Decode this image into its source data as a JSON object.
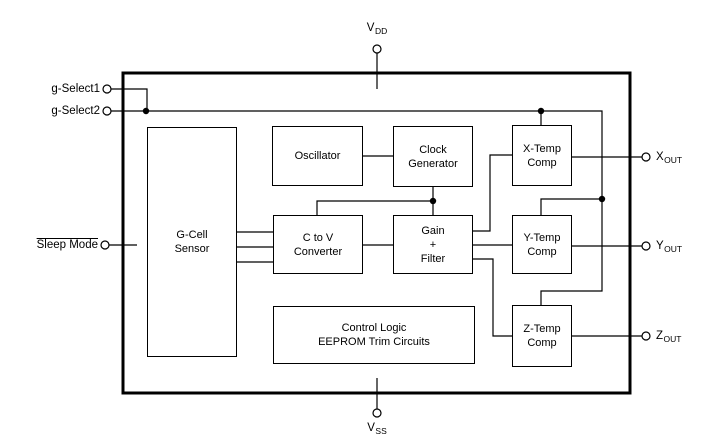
{
  "diagram": {
    "type": "block-diagram",
    "colors": {
      "line": "#000000",
      "background": "#ffffff",
      "text": "#000000"
    },
    "outer_box": {
      "x": 123,
      "y": 73,
      "w": 507,
      "h": 320
    },
    "blocks": [
      {
        "id": "g-cell-sensor",
        "label": [
          "G-Cell",
          "Sensor"
        ],
        "x": 147,
        "y": 127,
        "w": 90,
        "h": 230
      },
      {
        "id": "oscillator",
        "label": [
          "Oscillator"
        ],
        "x": 272,
        "y": 126,
        "w": 91,
        "h": 60
      },
      {
        "id": "clock-generator",
        "label": [
          "Clock",
          "Generator"
        ],
        "x": 393,
        "y": 126,
        "w": 80,
        "h": 61
      },
      {
        "id": "c-to-v-converter",
        "label": [
          "C to V",
          "Converter"
        ],
        "x": 273,
        "y": 215,
        "w": 90,
        "h": 59
      },
      {
        "id": "gain-filter",
        "label": [
          "Gain",
          "+",
          "Filter"
        ],
        "x": 393,
        "y": 215,
        "w": 80,
        "h": 59
      },
      {
        "id": "control-logic",
        "label": [
          "Control Logic",
          "EEPROM Trim Circuits"
        ],
        "x": 273,
        "y": 306,
        "w": 202,
        "h": 58
      },
      {
        "id": "x-temp-comp",
        "label": [
          "X-Temp",
          "Comp"
        ],
        "x": 512,
        "y": 125,
        "w": 60,
        "h": 61
      },
      {
        "id": "y-temp-comp",
        "label": [
          "Y-Temp",
          "Comp"
        ],
        "x": 512,
        "y": 215,
        "w": 60,
        "h": 59
      },
      {
        "id": "z-temp-comp",
        "label": [
          "Z-Temp",
          "Comp"
        ],
        "x": 512,
        "y": 305,
        "w": 60,
        "h": 62
      }
    ],
    "pins": [
      {
        "id": "vdd",
        "label": "V",
        "sub": "DD",
        "cx": 377,
        "cy": 49,
        "label_pos": "above",
        "overline": false
      },
      {
        "id": "vss",
        "label": "V",
        "sub": "SS",
        "cx": 377,
        "cy": 413,
        "label_pos": "below",
        "overline": false
      },
      {
        "id": "g-select1",
        "label": "g-Select1",
        "sub": "",
        "cx": 107,
        "cy": 89,
        "label_pos": "left",
        "overline": false
      },
      {
        "id": "g-select2",
        "label": "g-Select2",
        "sub": "",
        "cx": 107,
        "cy": 111,
        "label_pos": "left",
        "overline": false
      },
      {
        "id": "sleep-mode",
        "label": "Sleep Mode",
        "sub": "",
        "cx": 105,
        "cy": 245,
        "label_pos": "left",
        "overline": true
      },
      {
        "id": "xout",
        "label": "X",
        "sub": "OUT",
        "cx": 646,
        "cy": 157,
        "label_pos": "right",
        "overline": false
      },
      {
        "id": "yout",
        "label": "Y",
        "sub": "OUT",
        "cx": 646,
        "cy": 246,
        "label_pos": "right",
        "overline": false
      },
      {
        "id": "zout",
        "label": "Z",
        "sub": "OUT",
        "cx": 646,
        "cy": 336,
        "label_pos": "right",
        "overline": false
      }
    ],
    "wires": [
      {
        "id": "vdd-stub",
        "points": [
          [
            377,
            53
          ],
          [
            377,
            89
          ]
        ]
      },
      {
        "id": "vss-stub",
        "points": [
          [
            377,
            378
          ],
          [
            377,
            409
          ]
        ]
      },
      {
        "id": "g-select1-wire",
        "points": [
          [
            111,
            89
          ],
          [
            147,
            89
          ],
          [
            147,
            111
          ]
        ]
      },
      {
        "id": "g-select2-wire",
        "points": [
          [
            111,
            111
          ],
          [
            602,
            111
          ],
          [
            602,
            291
          ],
          [
            541,
            291
          ],
          [
            541,
            305
          ]
        ]
      },
      {
        "id": "x-temp-top-stub",
        "points": [
          [
            541,
            111
          ],
          [
            541,
            125
          ]
        ]
      },
      {
        "id": "y-temp-top-branch",
        "points": [
          [
            602,
            199
          ],
          [
            541,
            199
          ],
          [
            541,
            215
          ]
        ]
      },
      {
        "id": "sleep-mode-stub",
        "points": [
          [
            109,
            245
          ],
          [
            137,
            245
          ]
        ]
      },
      {
        "id": "osc-to-clock",
        "points": [
          [
            363,
            156
          ],
          [
            393,
            156
          ]
        ]
      },
      {
        "id": "clock-down",
        "points": [
          [
            433,
            187
          ],
          [
            433,
            215
          ]
        ]
      },
      {
        "id": "clock-to-ctov",
        "points": [
          [
            433,
            201
          ],
          [
            317,
            201
          ],
          [
            317,
            215
          ]
        ]
      },
      {
        "id": "gcell-to-ctov-1",
        "points": [
          [
            237,
            232
          ],
          [
            273,
            232
          ]
        ]
      },
      {
        "id": "gcell-to-ctov-2",
        "points": [
          [
            237,
            247
          ],
          [
            273,
            247
          ]
        ]
      },
      {
        "id": "gcell-to-ctov-3",
        "points": [
          [
            237,
            262
          ],
          [
            273,
            262
          ]
        ]
      },
      {
        "id": "ctov-to-gain",
        "points": [
          [
            363,
            245
          ],
          [
            393,
            245
          ]
        ]
      },
      {
        "id": "gain-to-xtemp",
        "points": [
          [
            473,
            231
          ],
          [
            490,
            231
          ],
          [
            490,
            155
          ],
          [
            512,
            155
          ]
        ]
      },
      {
        "id": "gain-to-ytemp",
        "points": [
          [
            473,
            245
          ],
          [
            512,
            245
          ]
        ]
      },
      {
        "id": "gain-to-ztemp",
        "points": [
          [
            473,
            259
          ],
          [
            493,
            259
          ],
          [
            493,
            336
          ],
          [
            512,
            336
          ]
        ]
      },
      {
        "id": "xout-wire",
        "points": [
          [
            572,
            157
          ],
          [
            642,
            157
          ]
        ]
      },
      {
        "id": "yout-wire",
        "points": [
          [
            572,
            246
          ],
          [
            642,
            246
          ]
        ]
      },
      {
        "id": "zout-wire",
        "points": [
          [
            572,
            336
          ],
          [
            642,
            336
          ]
        ]
      }
    ],
    "junction_dots": [
      [
        146,
        111
      ],
      [
        433,
        201
      ],
      [
        541,
        111
      ],
      [
        602,
        199
      ]
    ]
  }
}
